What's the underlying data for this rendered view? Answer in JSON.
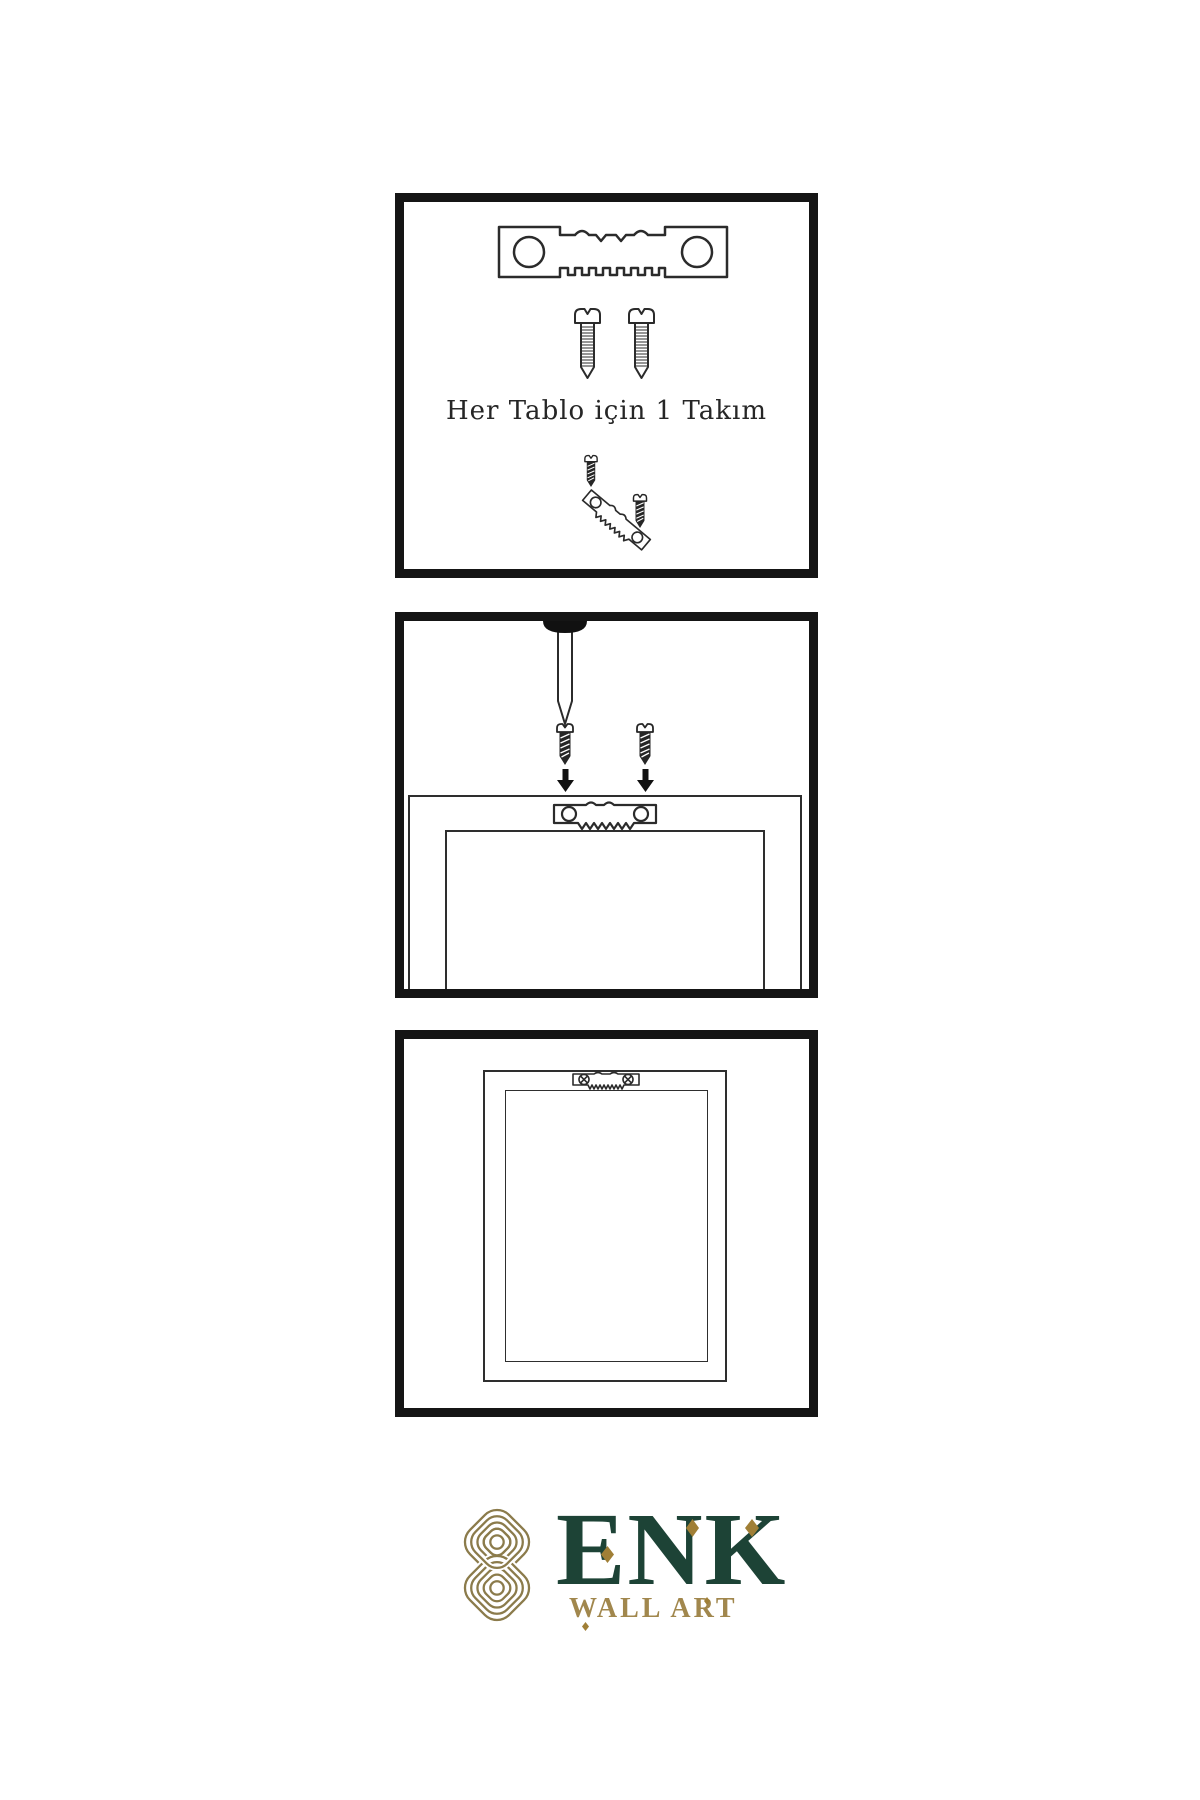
{
  "caption": {
    "text": "Her Tablo için 1 Takım"
  },
  "brand": {
    "name": "ENK",
    "subtitle": "WALL ART"
  },
  "colors": {
    "background": "#ffffff",
    "line": "#2b2b2b",
    "panel_border": "#151515",
    "dark_fill": "#222222",
    "brand_green": "#1d4336",
    "brand_gold": "#a1874d",
    "knot_gold": "#8b7b4b",
    "diamond_gold": "#a07f36"
  },
  "icons": {
    "sawtooth-hanger-icon": "sawtooth picture hanger plate with two screw holes",
    "screw-icon": "threaded screw, outline style",
    "dark-screw-icon": "short screw, dark filled",
    "nail-icon": "nail driven into wall from above",
    "arrow-down-icon": "solid downward arrow",
    "mounted-hanger-icon": "sawtooth hanger attached to frame back",
    "installed-hanger-icon": "sawtooth hanger fixed with phillips screws",
    "knot-logo-icon": "interlaced rounded knot monogram"
  }
}
